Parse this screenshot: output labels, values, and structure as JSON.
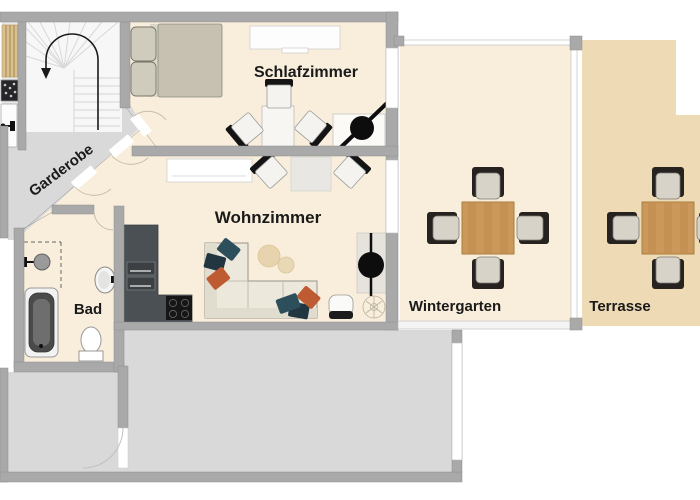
{
  "title": "Apartment floor plan",
  "rooms": {
    "schlafzimmer": {
      "label": "Schlafzimmer"
    },
    "wohnzimmer": {
      "label": "Wohnzimmer"
    },
    "garderobe": {
      "label": "Garderobe"
    },
    "bad": {
      "label": "Bad"
    },
    "wintergarten": {
      "label": "Wintergarten"
    },
    "terrasse": {
      "label": "Terrasse"
    }
  },
  "colors": {
    "room_floor": "#f8eedb",
    "terrace_floor": "#eedbb6",
    "hall_floor": "#d9d9d9",
    "stairs_floor": "#f7f7f7",
    "wall": "#a9a9a9",
    "kitchen_unit": "#4b5054",
    "wood_table": "#c9985a",
    "sofa": "#ece8dc",
    "pillow_teal": "#2d4f5c",
    "pillow_navy": "#223642",
    "pillow_orange": "#bf5b33",
    "text": "#1a1a1a"
  },
  "furniture_icons": [
    "stairs-icon",
    "direction-arrow-icon",
    "bed-icon",
    "sideboard-icon",
    "dining-set-icon",
    "desk-chair-icon",
    "sofa-icon",
    "pouf-icon",
    "kitchen-unit-icon",
    "cooktop-icon",
    "fireplace-column-icon",
    "laundry-basket-icon",
    "plant-icon",
    "shower-icon",
    "bathtub-icon",
    "washbasin-icon",
    "toilet-icon",
    "patio-dining-set-icon",
    "door-swing-icon",
    "window-icon",
    "wood-shelf-icon",
    "grill-icon",
    "sink-icon"
  ]
}
